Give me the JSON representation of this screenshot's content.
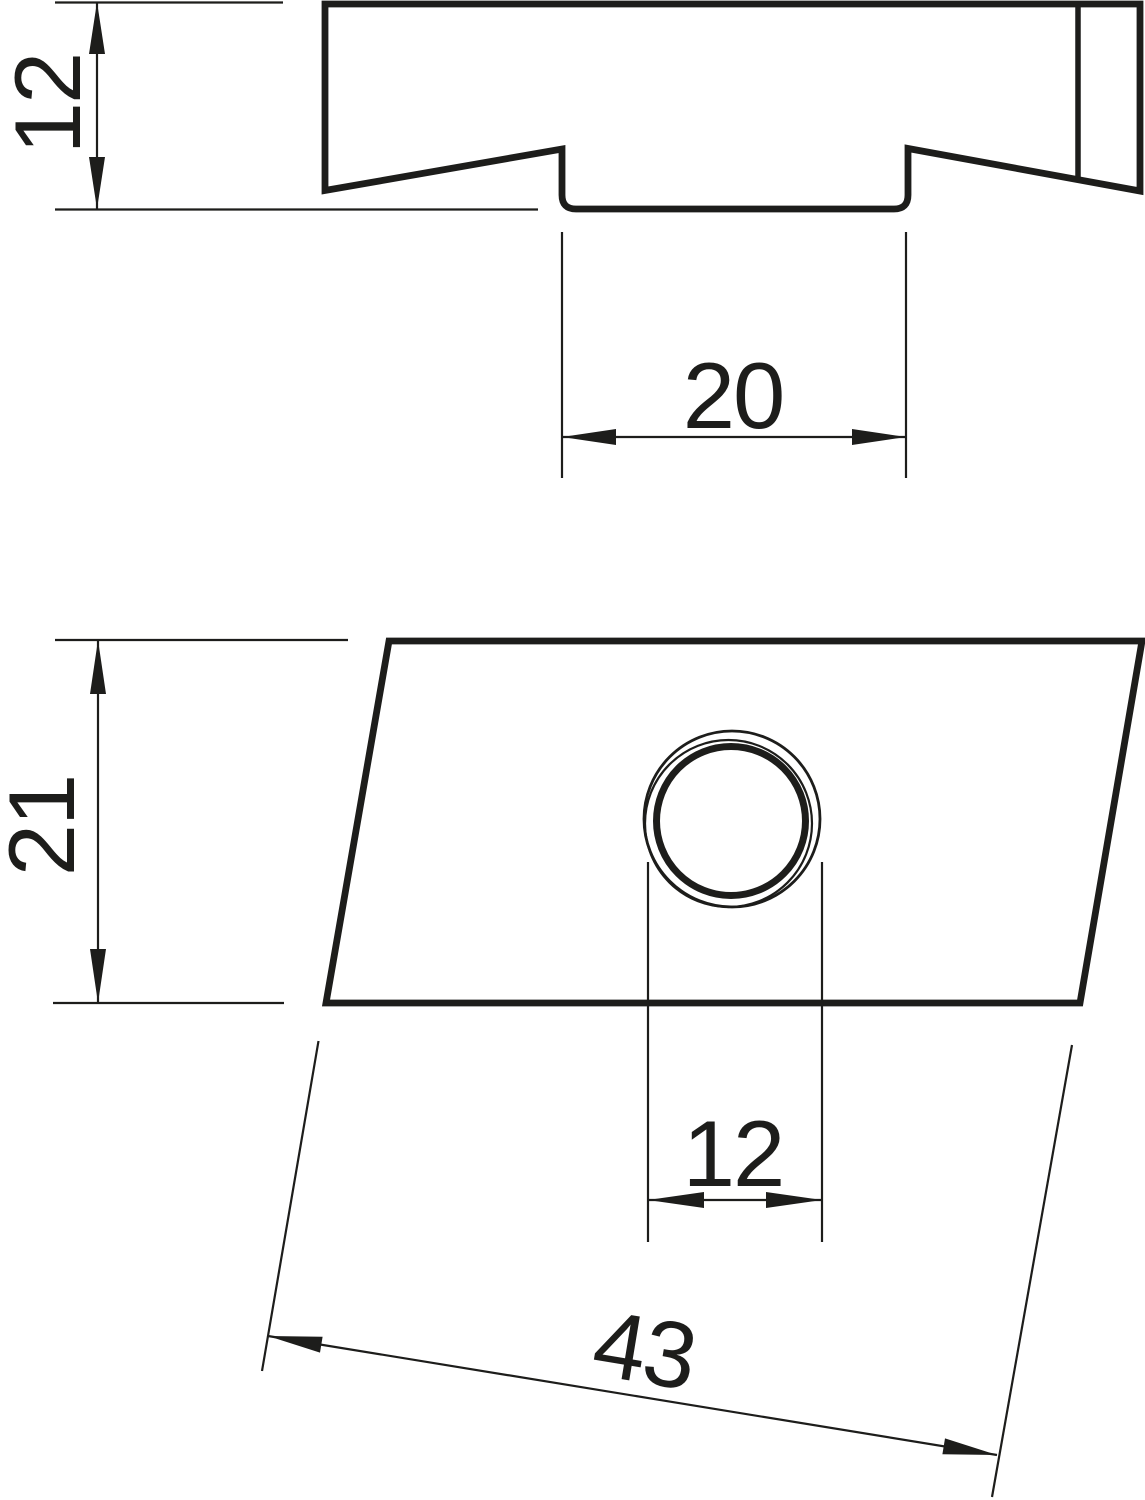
{
  "drawing": {
    "kind": "technical-dimension-drawing",
    "part": "slide-nut with threaded hole, two orthographic views",
    "background_color": "#ffffff",
    "line_color": "#1d1d1b"
  },
  "dims": {
    "side_height": "12",
    "slot_width": "20",
    "plan_depth": "21",
    "hole_diameter": "12",
    "plan_length": "43"
  }
}
